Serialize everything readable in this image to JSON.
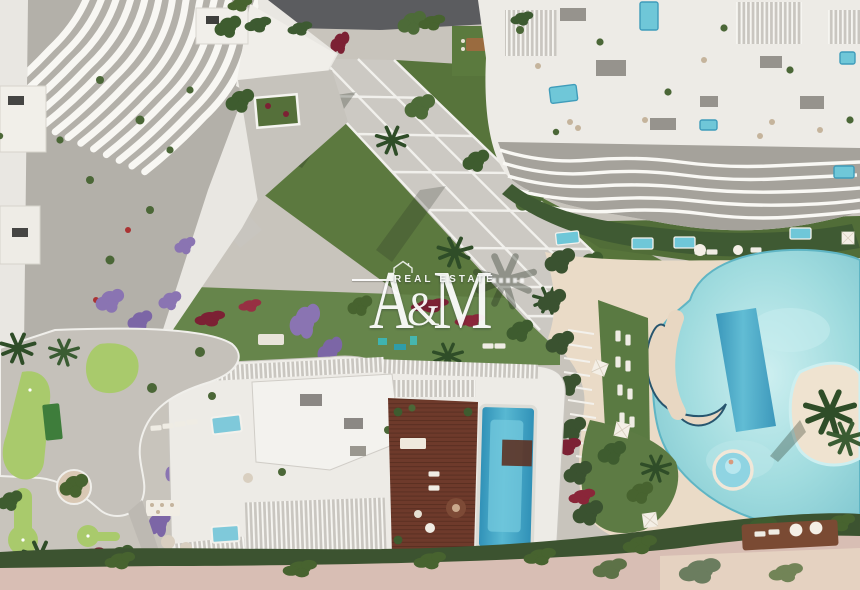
{
  "watermark": {
    "letter_a": "A",
    "ampersand": "&",
    "letter_m": "M",
    "tagline": "REAL ESTATE",
    "text_color": "#ffffff"
  },
  "scene": {
    "palette": {
      "building_white": "#edebe6",
      "lawn_green": "#5d7a40",
      "putting_green": "#a9ca6c",
      "flower_red": "#7c2134",
      "jacaranda_purple": "#8a74b2",
      "lagoon_pool": "#97d6db",
      "lap_pool": "#3f93b8",
      "rooftop_pool": "#35a0c4",
      "wood_deck": "#6e3a2b",
      "sand_deck": "#eadbc7",
      "path_gray": "#ccc9c3",
      "hedge_green": "#3c5330",
      "promenade_pink": "#d8beb4"
    }
  }
}
